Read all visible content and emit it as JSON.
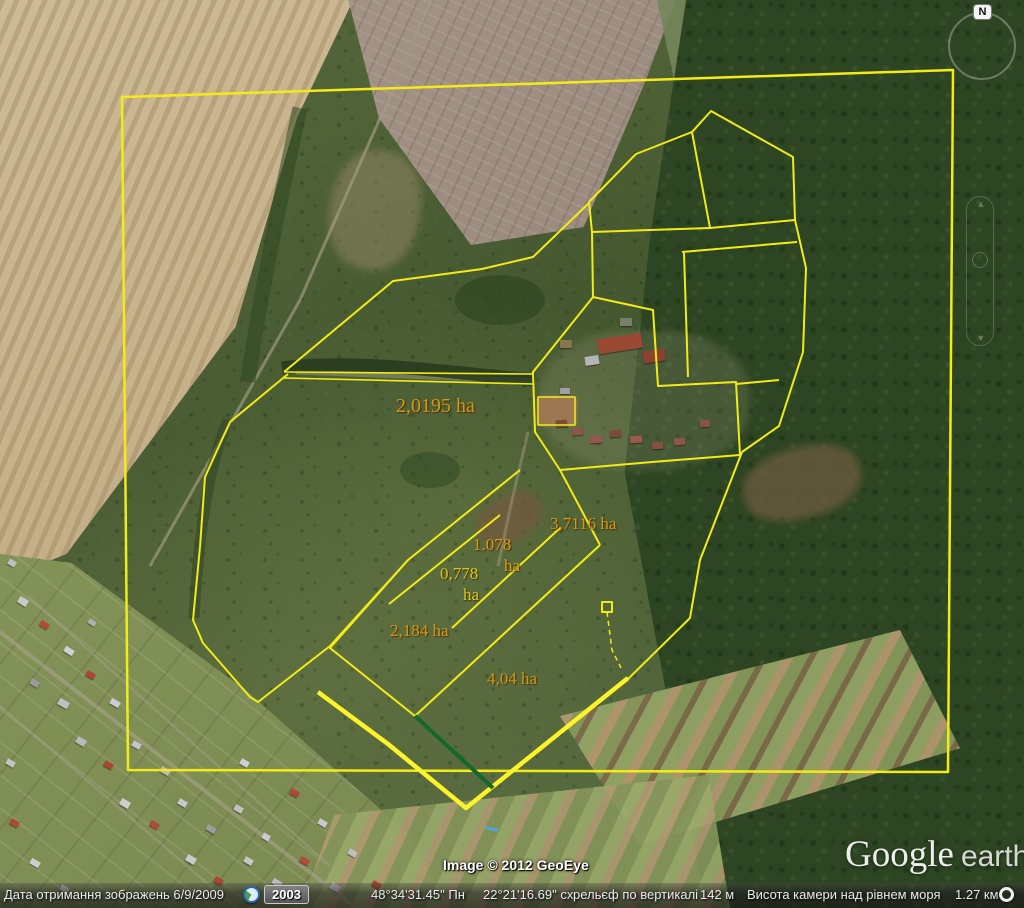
{
  "map": {
    "compass": {
      "label": "N"
    },
    "watermark": {
      "brand": "Google",
      "product": "earth"
    },
    "attribution": "Image © 2012 GeoEye",
    "parcel_labels": [
      {
        "name": "parcel-label-2-0195",
        "text": "2,0195 ha",
        "x": 396,
        "y": 395,
        "size": 20,
        "color": "#d09a18"
      },
      {
        "name": "parcel-label-3-7116",
        "text": "3,7116 ha",
        "x": 550,
        "y": 514,
        "size": 17,
        "color": "#d09a18"
      },
      {
        "name": "parcel-label-1-078",
        "text": "1.078",
        "x": 473,
        "y": 535,
        "size": 17,
        "color": "#cf9f1d",
        "suffix": "ha",
        "sx": 504,
        "sy": 556
      },
      {
        "name": "parcel-label-0-778",
        "text": "0,778",
        "x": 440,
        "y": 564,
        "size": 17,
        "color": "#d3c822",
        "suffix": "ha",
        "sx": 463,
        "sy": 585
      },
      {
        "name": "parcel-label-2-184",
        "text": "2,184 ha",
        "x": 390,
        "y": 621,
        "size": 17,
        "color": "#d09a18"
      },
      {
        "name": "parcel-label-4-04",
        "text": "4,04 ha",
        "x": 487,
        "y": 669,
        "size": 17,
        "color": "#c79a1a"
      }
    ],
    "boundaries": [
      {
        "name": "survey-frame",
        "points": [
          [
            122,
            97
          ],
          [
            953,
            70
          ],
          [
            948,
            772
          ],
          [
            128,
            770
          ]
        ],
        "closed": true,
        "width": 2.5
      },
      {
        "name": "pentagon-parcel",
        "points": [
          [
            692,
            132
          ],
          [
            711,
            111
          ],
          [
            793,
            157
          ],
          [
            795,
            220
          ],
          [
            710,
            228
          ]
        ],
        "closed": true,
        "width": 2
      },
      {
        "name": "northwest-chain",
        "points": [
          [
            692,
            132
          ],
          [
            636,
            154
          ],
          [
            589,
            202
          ],
          [
            592,
            232
          ],
          [
            593,
            297
          ]
        ],
        "width": 2
      },
      {
        "name": "cross-tie",
        "points": [
          [
            592,
            232
          ],
          [
            710,
            228
          ]
        ],
        "width": 2
      },
      {
        "name": "east-bulge",
        "points": [
          [
            795,
            220
          ],
          [
            806,
            268
          ],
          [
            803,
            352
          ],
          [
            779,
            426
          ],
          [
            742,
            452
          ]
        ],
        "width": 2
      },
      {
        "name": "east-parcel-top",
        "points": [
          [
            682,
            252
          ],
          [
            797,
            242
          ]
        ],
        "width": 2
      },
      {
        "name": "east-parcel-west-edge",
        "points": [
          [
            684,
            253
          ],
          [
            688,
            377
          ]
        ],
        "width": 2
      },
      {
        "name": "compound-outline",
        "points": [
          [
            533,
            372
          ],
          [
            593,
            297
          ],
          [
            653,
            310
          ],
          [
            658,
            386
          ],
          [
            736,
            382
          ],
          [
            740,
            455
          ],
          [
            652,
            462
          ],
          [
            560,
            470
          ],
          [
            535,
            432
          ]
        ],
        "closed": true,
        "width": 2
      },
      {
        "name": "courtyard",
        "points": [
          [
            538,
            397
          ],
          [
            575,
            397
          ],
          [
            575,
            425
          ],
          [
            538,
            425
          ]
        ],
        "closed": true,
        "width": 1.5
      },
      {
        "name": "track-upper",
        "points": [
          [
            284,
            372
          ],
          [
            533,
            374
          ]
        ],
        "width": 1.6
      },
      {
        "name": "track-lower",
        "points": [
          [
            284,
            378
          ],
          [
            533,
            384
          ]
        ],
        "width": 1.6
      },
      {
        "name": "north-arc",
        "points": [
          [
            284,
            372
          ],
          [
            393,
            281
          ],
          [
            482,
            269
          ],
          [
            533,
            257
          ],
          [
            589,
            203
          ]
        ],
        "width": 2
      },
      {
        "name": "west-parcel",
        "points": [
          [
            288,
            374
          ],
          [
            230,
            422
          ],
          [
            205,
            477
          ],
          [
            200,
            547
          ],
          [
            193,
            620
          ],
          [
            203,
            643
          ],
          [
            250,
            697
          ],
          [
            258,
            702
          ],
          [
            330,
            646
          ],
          [
            408,
            560
          ]
        ],
        "width": 2
      },
      {
        "name": "diamond-west",
        "points": [
          [
            408,
            560
          ],
          [
            330,
            648
          ],
          [
            415,
            716
          ]
        ],
        "width": 2
      },
      {
        "name": "long-diagonal",
        "points": [
          [
            415,
            716
          ],
          [
            600,
            545
          ]
        ],
        "width": 2
      },
      {
        "name": "strip-line-1",
        "points": [
          [
            408,
            560
          ],
          [
            520,
            470
          ]
        ],
        "width": 2
      },
      {
        "name": "strip-line-2",
        "points": [
          [
            389,
            604
          ],
          [
            500,
            515
          ]
        ],
        "width": 2
      },
      {
        "name": "strip-line-3",
        "points": [
          [
            452,
            628
          ],
          [
            560,
            528
          ]
        ],
        "width": 2
      },
      {
        "name": "compound-south-link",
        "points": [
          [
            560,
            470
          ],
          [
            600,
            545
          ]
        ],
        "width": 2
      },
      {
        "name": "east-lower-boundary",
        "points": [
          [
            742,
            452
          ],
          [
            700,
            560
          ],
          [
            690,
            618
          ],
          [
            627,
            680
          ]
        ],
        "width": 2
      },
      {
        "name": "east-link",
        "points": [
          [
            736,
            384
          ],
          [
            779,
            380
          ]
        ],
        "width": 2
      },
      {
        "name": "marker-tail",
        "points": [
          [
            607,
            612
          ],
          [
            612,
            650
          ],
          [
            621,
            668
          ]
        ],
        "width": 1.5,
        "dash": "5 4"
      },
      {
        "name": "survey-square-marker",
        "points": [
          [
            602,
            602
          ],
          [
            612,
            602
          ],
          [
            612,
            612
          ],
          [
            602,
            612
          ]
        ],
        "closed": true,
        "width": 2
      },
      {
        "name": "south-boundary-bold",
        "points": [
          [
            318,
            692
          ],
          [
            388,
            744
          ],
          [
            466,
            808
          ],
          [
            628,
            678
          ]
        ],
        "width": 4.5,
        "color": "#fdf32a"
      },
      {
        "name": "field-line-green",
        "points": [
          [
            415,
            716
          ],
          [
            493,
            788
          ]
        ],
        "width": 4,
        "color": "#15672e"
      },
      {
        "name": "water-marker-blue",
        "points": [
          [
            486,
            828
          ],
          [
            498,
            830
          ]
        ],
        "width": 3,
        "color": "#49a8dd"
      }
    ]
  },
  "status_bar": {
    "imagery_date": "Дата отримання зображень 6/9/2009",
    "timeline_year": "2003",
    "latitude": "48°34'31.45\" Пн",
    "longitude": "22°21'16.69\" сх.",
    "terrain_label": "рельєф по вертикалі",
    "terrain_elevation": "142 м",
    "camera_label": "Висота камери над рівнем моря",
    "camera_altitude": "1.27 км"
  }
}
